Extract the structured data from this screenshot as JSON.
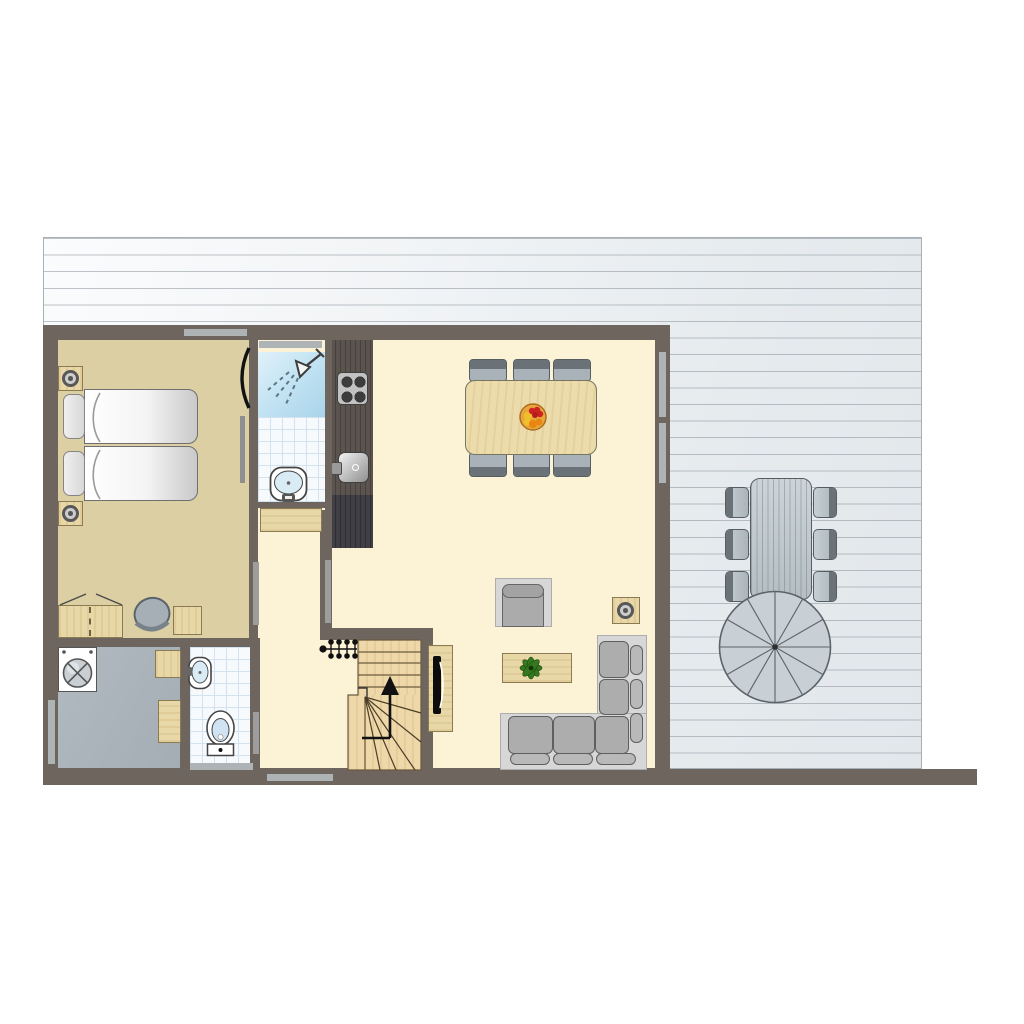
{
  "title": "holiday-home-ground-floor-plan",
  "colors": {
    "wall": "#6e655e",
    "floor_cream": "#fcf2d6",
    "floor_tan": "#dccfa4",
    "laundry_floor": "#aab4ba",
    "wood": "#e9d8a7",
    "stairs_wood": "#eed7a8",
    "counter": "#5a534e",
    "counter_tall": "#403f46",
    "tile_line": "#d3e2ef",
    "shower_blue": "#b9dff0",
    "window": "#aeb3b6",
    "door": "#9d9d9d",
    "deck_line": "#8a949b",
    "outdoor_fill": "#c2cbd0",
    "outline": "#565e63",
    "sofa_cushion": "#adadad",
    "plant_green": "#35781f",
    "fruit_red": "#cc2222",
    "fruit_orange": "#e8860f",
    "fruit_yellow": "#f0c02a"
  },
  "plan": {
    "rooms": [
      "terrace",
      "bedroom",
      "bathroom",
      "hallway",
      "kitchen",
      "living-dining-room",
      "laundry-room",
      "toilet",
      "stairwell"
    ],
    "labels": {
      "terrace": "terrace deck",
      "bedroom": "bedroom",
      "bathroom": "bathroom with shower",
      "hallway": "hallway",
      "kitchen": "kitchen",
      "living": "living and dining room",
      "laundry": "laundry room",
      "toilet": "toilet",
      "stairs": "staircase up"
    },
    "furniture": {
      "bedroom": [
        "twin-beds",
        "nightstand-left-top",
        "nightstand-left-bottom",
        "wardrobe",
        "chair",
        "side-table"
      ],
      "bathroom": [
        "shower",
        "washbasin",
        "cabinet"
      ],
      "kitchen": [
        "counter",
        "stove-4-burners",
        "sink",
        "tall-cabinet"
      ],
      "living_dining": [
        "dining-table",
        "dining-chairs-x6",
        "fruit-bowl",
        "armchair",
        "speaker-table",
        "coffee-table",
        "plant",
        "corner-sofa",
        "tv-cabinet",
        "tv"
      ],
      "laundry": [
        "washing-machine",
        "worktable-small",
        "worktable-tall"
      ],
      "toilet": [
        "toilet",
        "washbasin-small"
      ],
      "terrace": [
        "picnic-table",
        "outdoor-chairs-x6",
        "parasol"
      ]
    }
  }
}
